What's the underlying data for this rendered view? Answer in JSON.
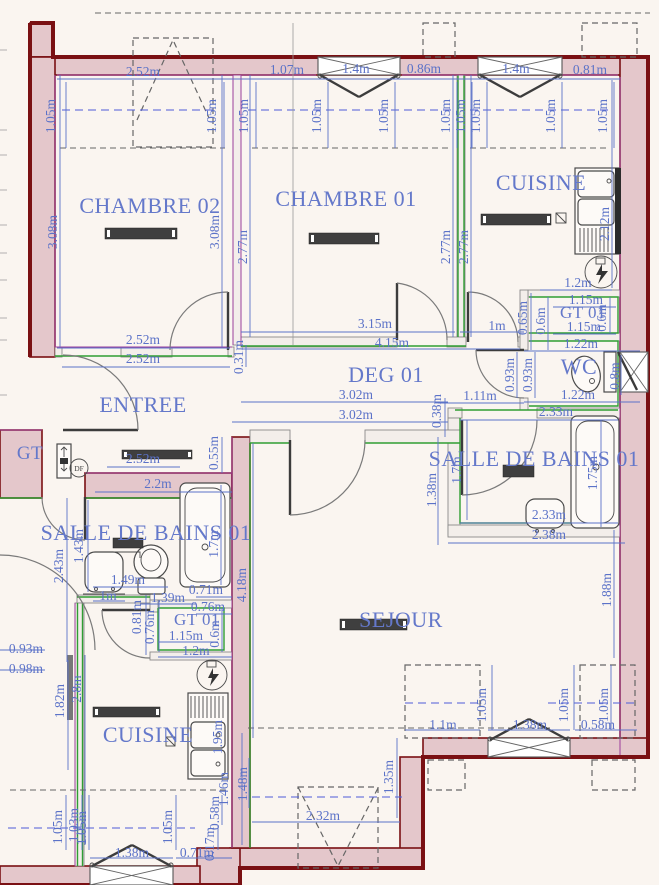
{
  "colors": {
    "wall_fill": "#e4c7cb",
    "wall_outline": "#7a1013",
    "dimension_blue": "#5b72c8",
    "label_blue": "#6478ca",
    "insulation_green": "#2f9e33",
    "wall_accent_purple": "#9b3e9b"
  },
  "fixtures": {
    "df_label": "DF"
  },
  "rooms": [
    {
      "label": "CHAMBRE 02",
      "x": 150,
      "y": 213,
      "size": 22
    },
    {
      "label": "CHAMBRE 01",
      "x": 346,
      "y": 206,
      "size": 22
    },
    {
      "label": "CUISINE",
      "x": 541,
      "y": 190,
      "size": 22
    },
    {
      "label": "DEG 01",
      "x": 386,
      "y": 382,
      "size": 22
    },
    {
      "label": "ENTREE",
      "x": 143,
      "y": 412,
      "size": 22
    },
    {
      "label": "GT 01",
      "x": 583,
      "y": 318,
      "size": 17
    },
    {
      "label": "WC",
      "x": 579,
      "y": 374,
      "size": 22
    },
    {
      "label": "SALLE DE BAINS 01",
      "x": 534,
      "y": 466,
      "size": 22
    },
    {
      "label": "SALLE DE BAINS 01",
      "x": 146,
      "y": 540,
      "size": 22
    },
    {
      "label": "GT 01",
      "x": 197,
      "y": 625,
      "size": 17
    },
    {
      "label": "CUISINE",
      "x": 148,
      "y": 742,
      "size": 22
    },
    {
      "label": "SEJOUR",
      "x": 401,
      "y": 627,
      "size": 22
    },
    {
      "label": "GT",
      "x": 30,
      "y": 459,
      "size": 19
    }
  ],
  "dims": [
    {
      "t": "2.52m",
      "x": 143,
      "y": 76
    },
    {
      "t": "1.07m",
      "x": 287,
      "y": 74
    },
    {
      "t": "1.4m",
      "x": 356,
      "y": 73
    },
    {
      "t": "0.86m",
      "x": 424,
      "y": 73
    },
    {
      "t": "1.4m",
      "x": 516,
      "y": 73
    },
    {
      "t": "0.81m",
      "x": 590,
      "y": 74
    },
    {
      "t": "1.05m",
      "x": 55,
      "y": 116,
      "r": 1
    },
    {
      "t": "1.05m",
      "x": 216,
      "y": 116,
      "r": 1
    },
    {
      "t": "1.05m",
      "x": 248,
      "y": 116,
      "r": 1
    },
    {
      "t": "1.05m",
      "x": 321,
      "y": 116,
      "r": 1
    },
    {
      "t": "1.05m",
      "x": 388,
      "y": 116,
      "r": 1
    },
    {
      "t": "1.05m",
      "x": 450,
      "y": 116,
      "r": 1
    },
    {
      "t": "1.05m",
      "x": 465,
      "y": 116,
      "r": 1
    },
    {
      "t": "1.05m",
      "x": 480,
      "y": 116,
      "r": 1
    },
    {
      "t": "1.05m",
      "x": 555,
      "y": 116,
      "r": 1
    },
    {
      "t": "1.05m",
      "x": 607,
      "y": 116,
      "r": 1
    },
    {
      "t": "3.08m",
      "x": 57,
      "y": 232,
      "r": 1
    },
    {
      "t": "3.08m",
      "x": 219,
      "y": 232,
      "r": 1
    },
    {
      "t": "2.52m",
      "x": 143,
      "y": 344
    },
    {
      "t": "2.52m",
      "x": 143,
      "y": 363
    },
    {
      "t": "2.77m",
      "x": 247,
      "y": 247,
      "r": 1
    },
    {
      "t": "2.77m",
      "x": 450,
      "y": 247,
      "r": 1
    },
    {
      "t": "2.77m",
      "x": 468,
      "y": 247,
      "r": 1
    },
    {
      "t": "3.15m",
      "x": 375,
      "y": 328
    },
    {
      "t": "4.15m",
      "x": 392,
      "y": 347
    },
    {
      "t": "2.12m",
      "x": 609,
      "y": 224,
      "r": 1
    },
    {
      "t": "1.2m",
      "x": 578,
      "y": 287
    },
    {
      "t": "1.15m",
      "x": 586,
      "y": 304
    },
    {
      "t": "1m",
      "x": 497,
      "y": 330
    },
    {
      "t": "0.65m",
      "x": 527,
      "y": 318,
      "r": 1
    },
    {
      "t": "0.6m",
      "x": 545,
      "y": 321,
      "r": 1
    },
    {
      "t": "1.15m",
      "x": 584,
      "y": 331
    },
    {
      "t": "0.6m",
      "x": 606,
      "y": 318,
      "r": 1
    },
    {
      "t": "1.22m",
      "x": 581,
      "y": 348
    },
    {
      "t": "0.93m",
      "x": 514,
      "y": 375,
      "r": 1
    },
    {
      "t": "0.93m",
      "x": 532,
      "y": 375,
      "r": 1
    },
    {
      "t": "1.11m",
      "x": 480,
      "y": 400
    },
    {
      "t": "1.22m",
      "x": 578,
      "y": 399
    },
    {
      "t": "0.8m",
      "x": 619,
      "y": 376,
      "r": 1
    },
    {
      "t": "0.31m",
      "x": 243,
      "y": 357,
      "r": 1
    },
    {
      "t": "3.02m",
      "x": 356,
      "y": 399
    },
    {
      "t": "3.02m",
      "x": 356,
      "y": 419
    },
    {
      "t": "0.38m",
      "x": 441,
      "y": 411,
      "r": 1
    },
    {
      "t": "2.52m",
      "x": 143,
      "y": 463
    },
    {
      "t": "0.55m",
      "x": 218,
      "y": 453,
      "r": 1
    },
    {
      "t": "2.2m",
      "x": 158,
      "y": 488
    },
    {
      "t": "2.33m",
      "x": 556,
      "y": 416
    },
    {
      "t": "1.38m",
      "x": 436,
      "y": 490,
      "r": 1
    },
    {
      "t": "1.7m",
      "x": 461,
      "y": 470,
      "r": 1
    },
    {
      "t": "1.75m",
      "x": 597,
      "y": 473,
      "r": 1
    },
    {
      "t": "2.33m",
      "x": 549,
      "y": 519
    },
    {
      "t": "2.38m",
      "x": 549,
      "y": 539
    },
    {
      "t": "1.88m",
      "x": 611,
      "y": 590,
      "r": 1
    },
    {
      "t": "2.43m",
      "x": 63,
      "y": 566,
      "r": 1
    },
    {
      "t": "1.43m",
      "x": 83,
      "y": 546,
      "r": 1
    },
    {
      "t": "1.49m",
      "x": 128,
      "y": 584
    },
    {
      "t": "1m",
      "x": 108,
      "y": 600
    },
    {
      "t": "1.39m",
      "x": 168,
      "y": 602
    },
    {
      "t": "0.71m",
      "x": 206,
      "y": 594
    },
    {
      "t": "0.76m",
      "x": 208,
      "y": 611
    },
    {
      "t": "0.81m",
      "x": 141,
      "y": 617,
      "r": 1
    },
    {
      "t": "0.76m",
      "x": 154,
      "y": 627,
      "r": 1
    },
    {
      "t": "1.15m",
      "x": 186,
      "y": 640
    },
    {
      "t": "0.6m",
      "x": 219,
      "y": 634,
      "r": 1
    },
    {
      "t": "1.2m",
      "x": 196,
      "y": 655
    },
    {
      "t": "0.93m",
      "x": 26,
      "y": 653
    },
    {
      "t": "0.98m",
      "x": 26,
      "y": 673
    },
    {
      "t": "1.7m",
      "x": 218,
      "y": 544,
      "r": 1
    },
    {
      "t": "1.82m",
      "x": 64,
      "y": 701,
      "r": 1
    },
    {
      "t": "2.8m",
      "x": 81,
      "y": 689,
      "r": 1
    },
    {
      "t": "1.95m",
      "x": 222,
      "y": 737,
      "r": 1
    },
    {
      "t": "1.05m",
      "x": 62,
      "y": 827,
      "r": 1
    },
    {
      "t": "1.03m",
      "x": 78,
      "y": 825,
      "r": 1
    },
    {
      "t": "1.05m",
      "x": 86,
      "y": 828,
      "r": 1
    },
    {
      "t": "1.05m",
      "x": 172,
      "y": 827,
      "r": 1
    },
    {
      "t": "1.38m",
      "x": 132,
      "y": 857
    },
    {
      "t": "0.71m",
      "x": 197,
      "y": 857
    },
    {
      "t": "0.17m",
      "x": 214,
      "y": 844,
      "r": 1
    },
    {
      "t": "0.58m",
      "x": 219,
      "y": 813,
      "r": 1
    },
    {
      "t": "1.48m",
      "x": 247,
      "y": 784,
      "r": 1
    },
    {
      "t": "1.46m",
      "x": 228,
      "y": 789,
      "r": 1
    },
    {
      "t": "4.18m",
      "x": 246,
      "y": 585,
      "r": 1
    },
    {
      "t": "1.1m",
      "x": 443,
      "y": 729
    },
    {
      "t": "1.38m",
      "x": 530,
      "y": 729
    },
    {
      "t": "0.58m",
      "x": 598,
      "y": 729
    },
    {
      "t": "1.05m",
      "x": 486,
      "y": 705,
      "r": 1
    },
    {
      "t": "1.05m",
      "x": 568,
      "y": 705,
      "r": 1
    },
    {
      "t": "1.05m",
      "x": 608,
      "y": 705,
      "r": 1
    },
    {
      "t": "2.32m",
      "x": 323,
      "y": 820
    },
    {
      "t": "1.35m",
      "x": 393,
      "y": 777,
      "r": 1
    }
  ]
}
